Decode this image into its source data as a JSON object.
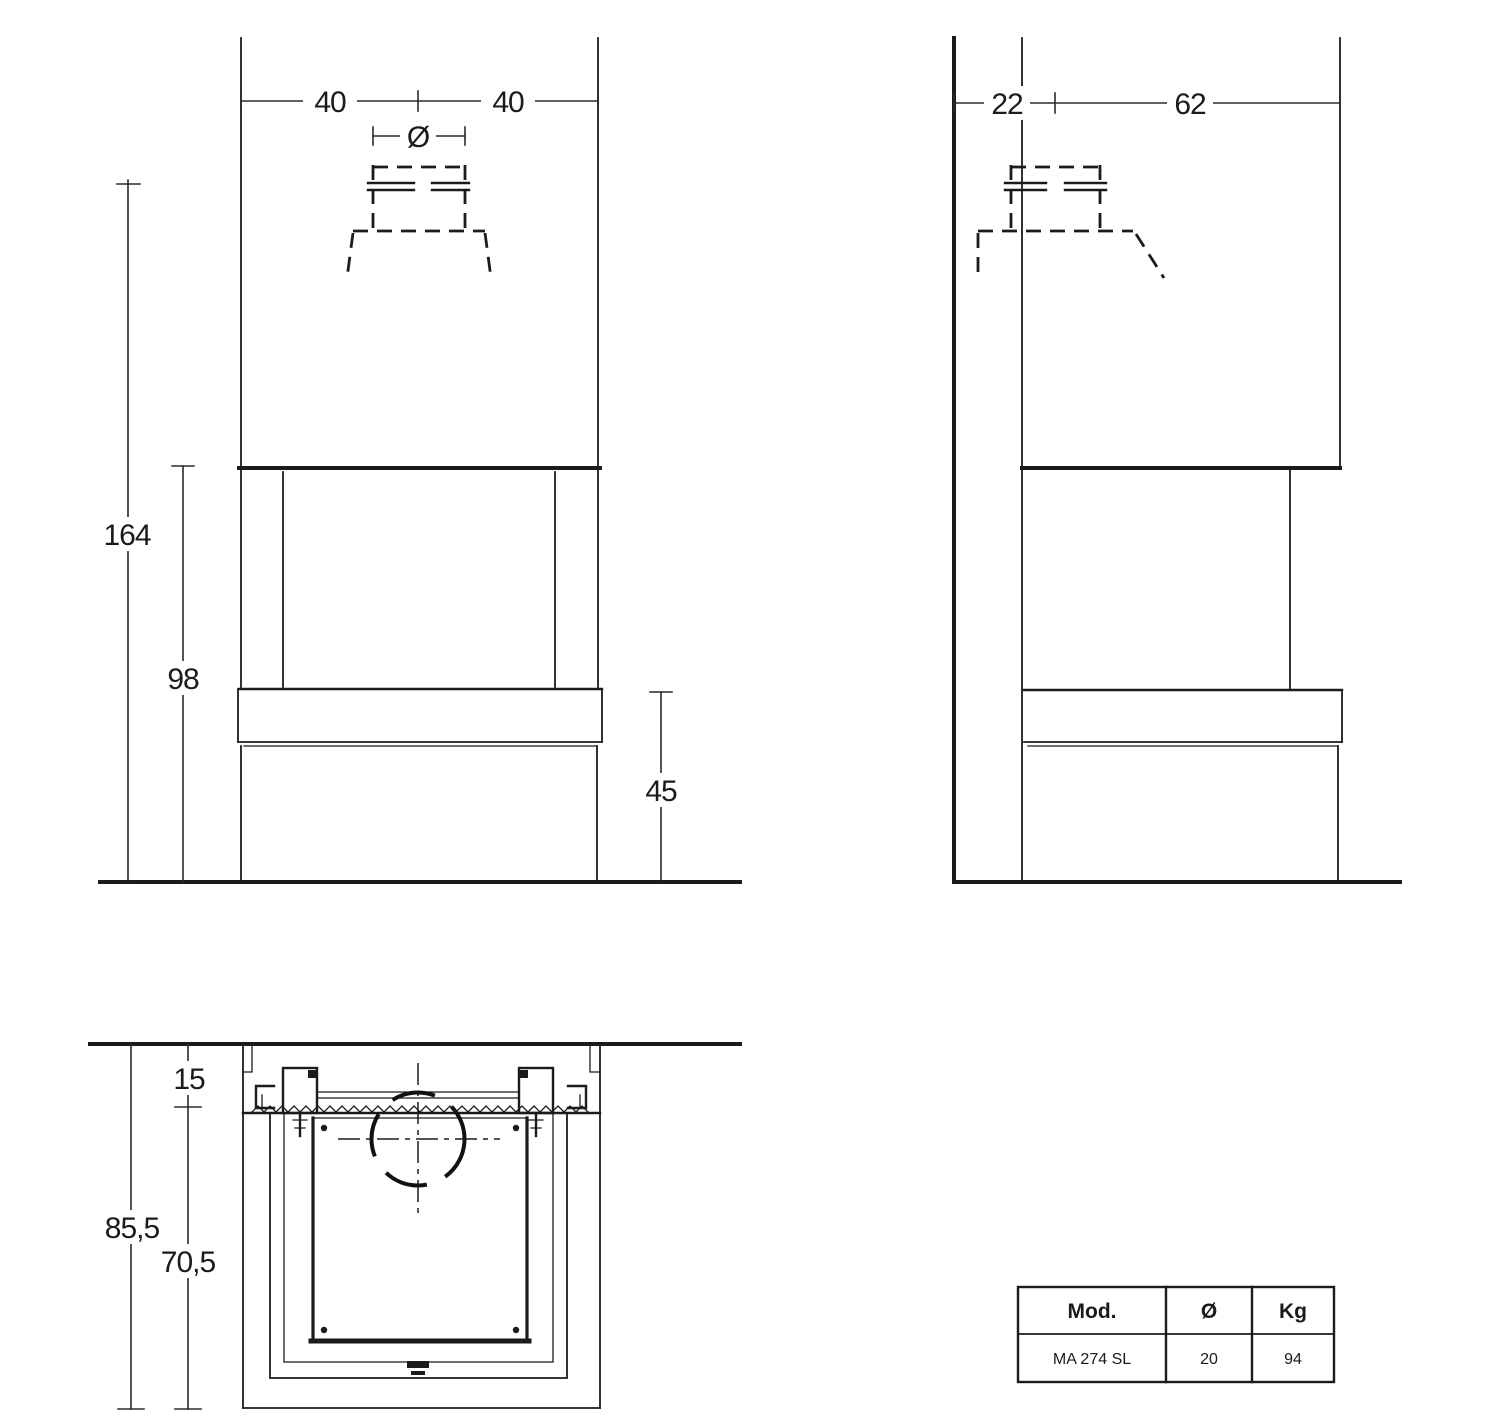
{
  "page": {
    "background_color": "#ffffff",
    "line_color": "#1b1b1b"
  },
  "front_view": {
    "dims": {
      "width_left": "40",
      "width_right": "40",
      "flue_symbol": "Ø",
      "height_total": "164",
      "height_opening": "98",
      "height_bench": "45"
    }
  },
  "side_view": {
    "dims": {
      "depth_wall_to_flue": "22",
      "depth_flue_to_front": "62"
    }
  },
  "plan_view": {
    "dims": {
      "wall_offset": "15",
      "depth_total": "85,5",
      "depth_inner": "70,5"
    }
  },
  "spec_table": {
    "headers": [
      "Mod.",
      "Ø",
      "Kg"
    ],
    "rows": [
      [
        "MA 274 SL",
        "20",
        "94"
      ]
    ]
  }
}
